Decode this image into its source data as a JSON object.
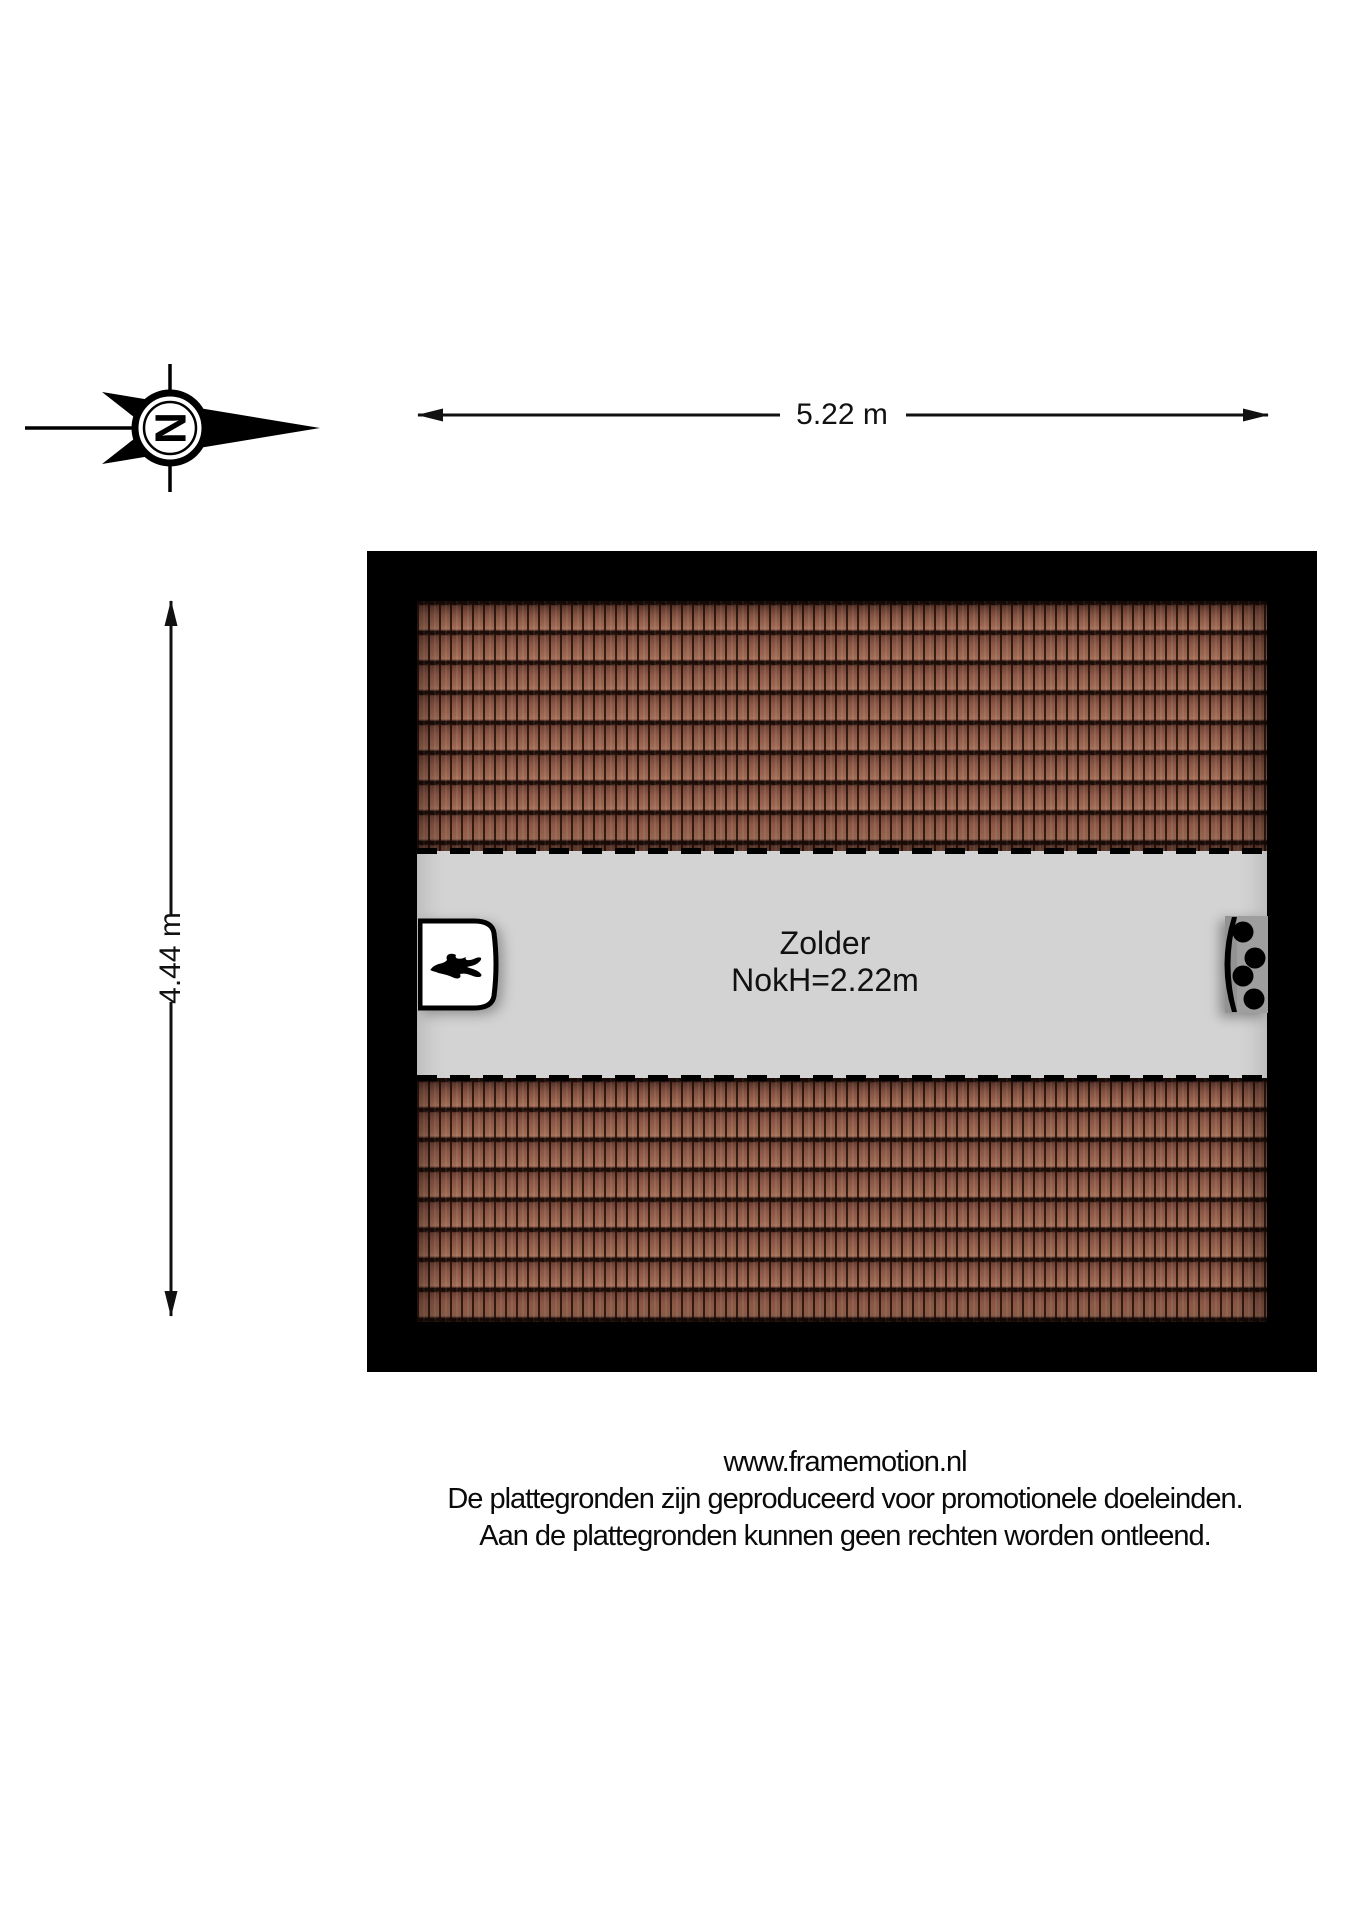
{
  "compass": {
    "letter": "N"
  },
  "dimensions": {
    "width": {
      "label": "5.22 m"
    },
    "height": {
      "label": "4.44 m"
    }
  },
  "plan": {
    "room_label": "Zolder",
    "ridge_height_label": "NokH=2.22m",
    "colors": {
      "wall": "#000000",
      "floor": "#d3d3d3",
      "tile_base": "#8d5847",
      "tile_highlight": "#a5705a",
      "tile_gap": "#1c0c07",
      "boiler_fill": "#ffffff",
      "unit_gray": "#9e9e9e"
    }
  },
  "footer": {
    "line1": "www.framemotion.nl",
    "line2": "De plattegronden zijn geproduceerd voor promotionele doeleinden.",
    "line3": "Aan de plattegronden kunnen geen rechten worden ontleend."
  }
}
